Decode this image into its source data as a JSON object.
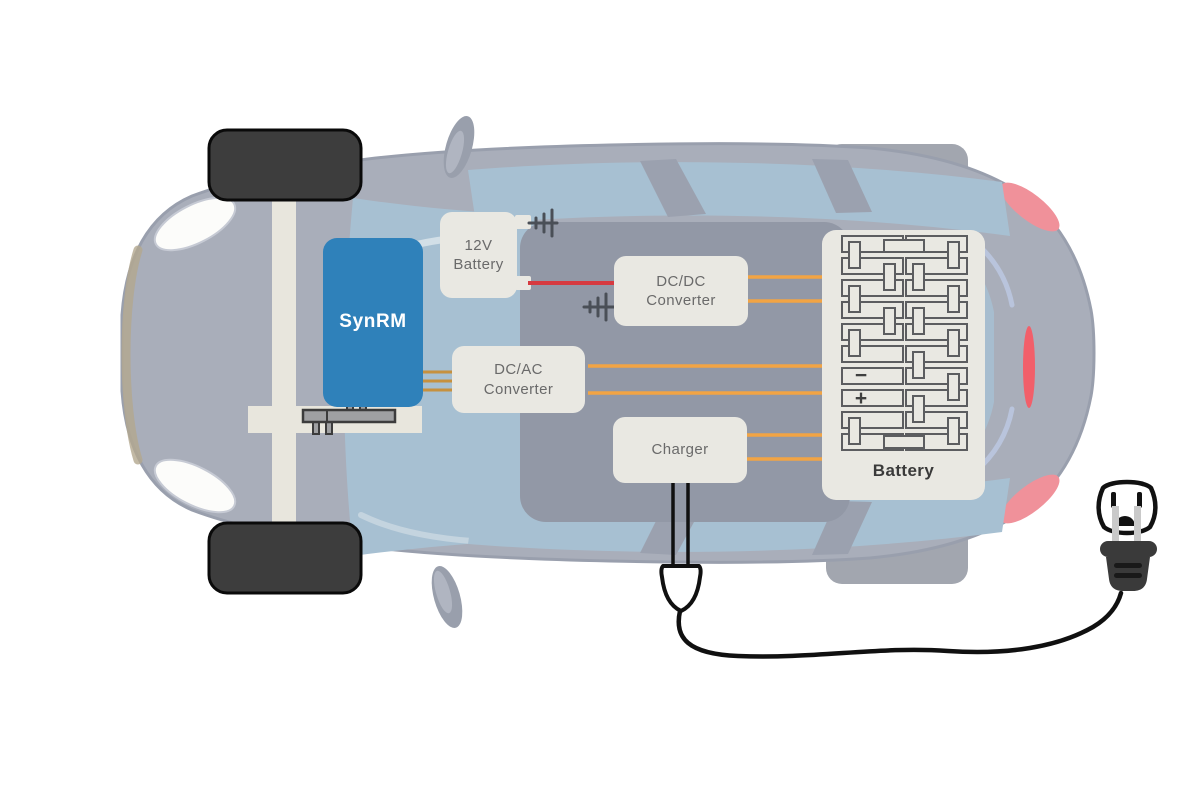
{
  "diagram": {
    "motor": {
      "label": "SynRM"
    },
    "aux_battery": {
      "line1": "12V",
      "line2": "Battery"
    },
    "dc_ac_converter": {
      "line1": "DC/AC",
      "line2": "Converter"
    },
    "dc_dc_converter": {
      "line1": "DC/DC",
      "line2": "Converter"
    },
    "charger": {
      "label": "Charger"
    },
    "traction_battery": {
      "label": "Battery",
      "terminal_negative": "−",
      "terminal_positive": "+"
    },
    "colors": {
      "motor_blue": "#2F81BA",
      "component_box": "#E9E8E2",
      "wire_orange": "#F2A444",
      "wire_tan": "#C6913F",
      "wire_red": "#D63A40",
      "ground_symbol": "#4A4F57",
      "label_text": "#6A6A6A",
      "battery_label_text": "#3A3A3A",
      "car_body": "#A9AEBA",
      "glass_blue": "#A7C0D2",
      "tail_light_pink": "#F0919A",
      "cable_black": "#101010"
    }
  }
}
